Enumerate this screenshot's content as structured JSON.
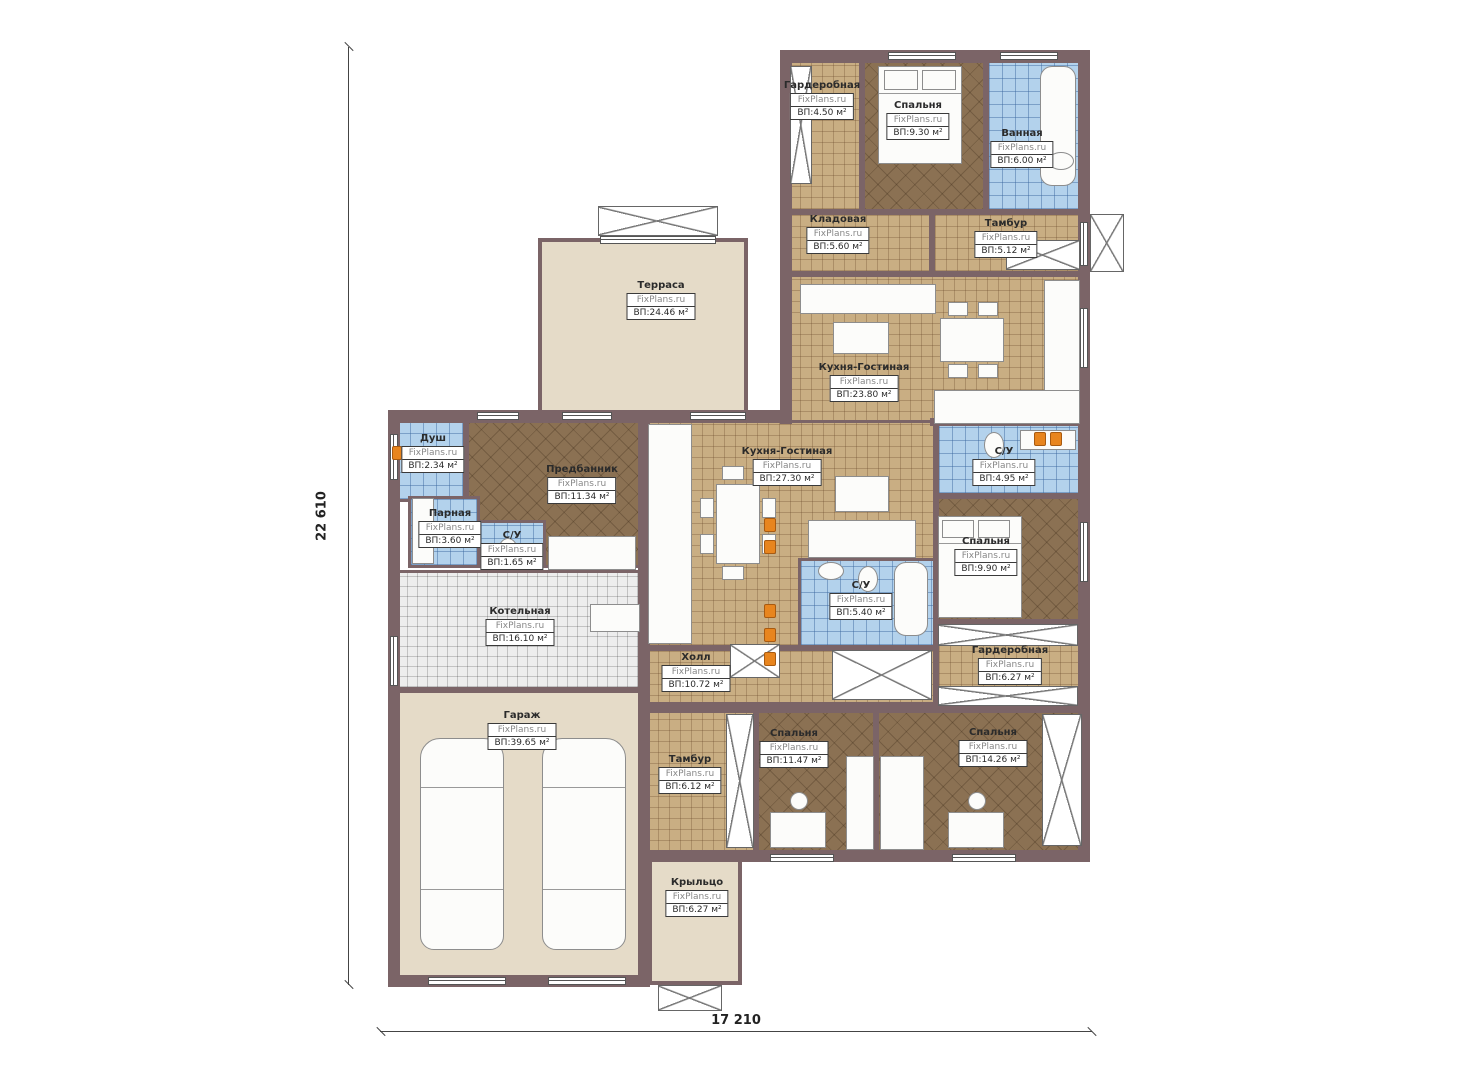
{
  "plan": {
    "site": "FixPlans.ru",
    "dimensions": {
      "height_mm": "22 610",
      "width_mm": "17 210"
    }
  },
  "rooms": [
    {
      "name": "Гардеробная",
      "area": "ВП:4.50 м²"
    },
    {
      "name": "Спальня",
      "area": "ВП:9.30 м²"
    },
    {
      "name": "Ванная",
      "area": "ВП:6.00 м²"
    },
    {
      "name": "Кладовая",
      "area": "ВП:5.60 м²"
    },
    {
      "name": "Тамбур",
      "area": "ВП:5.12 м²"
    },
    {
      "name": "Терраса",
      "area": "ВП:24.46 м²"
    },
    {
      "name": "Кухня-Гостиная",
      "area": "ВП:23.80 м²"
    },
    {
      "name": "Душ",
      "area": "ВП:2.34 м²"
    },
    {
      "name": "Предбанник",
      "area": "ВП:11.34 м²"
    },
    {
      "name": "Кухня-Гостиная",
      "area": "ВП:27.30 м²"
    },
    {
      "name": "С/У",
      "area": "ВП:4.95 м²"
    },
    {
      "name": "Парная",
      "area": "ВП:3.60 м²"
    },
    {
      "name": "С/У",
      "area": "ВП:1.65 м²"
    },
    {
      "name": "Спальня",
      "area": "ВП:9.90 м²"
    },
    {
      "name": "С/У",
      "area": "ВП:5.40 м²"
    },
    {
      "name": "Котельная",
      "area": "ВП:16.10 м²"
    },
    {
      "name": "Холл",
      "area": "ВП:10.72 м²"
    },
    {
      "name": "Гардеробная",
      "area": "ВП:6.27 м²"
    },
    {
      "name": "Гараж",
      "area": "ВП:39.65 м²"
    },
    {
      "name": "Тамбур",
      "area": "ВП:6.12 м²"
    },
    {
      "name": "Спальня",
      "area": "ВП:11.47 м²"
    },
    {
      "name": "Спальня",
      "area": "ВП:14.26 м²"
    },
    {
      "name": "Крыльцо",
      "area": "ВП:6.27 м²"
    }
  ]
}
